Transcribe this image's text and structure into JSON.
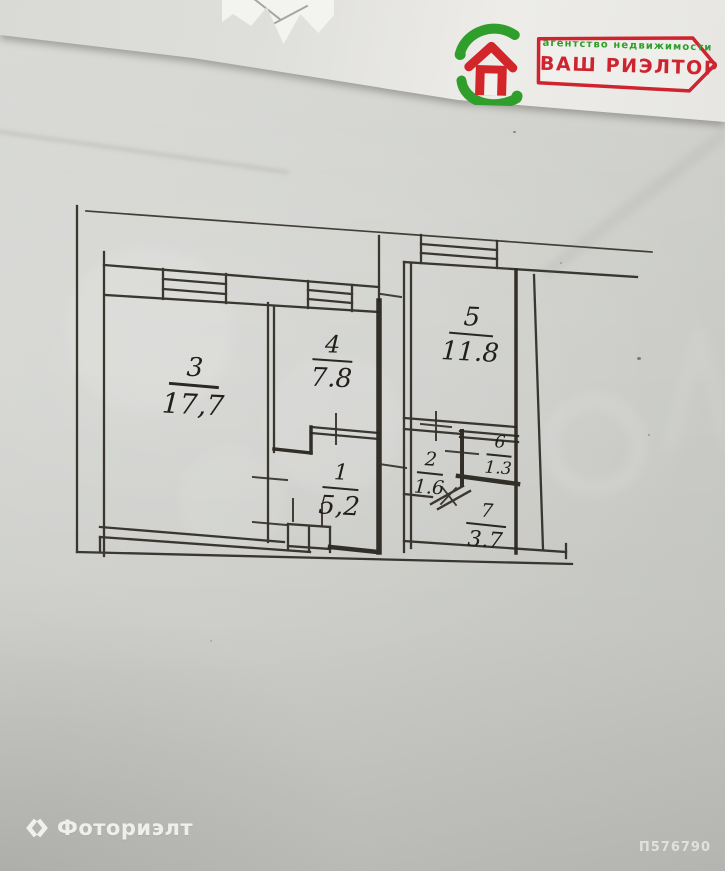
{
  "brand_card": {
    "tagline": "агентство недвижимости",
    "brand": "ВАШ РИЭЛТОР",
    "colors": {
      "red": "#cf2430",
      "green": "#2f9e2a"
    }
  },
  "floor_plan": {
    "ink_color": "#322e28",
    "rooms": [
      {
        "number": "3",
        "area": "17,7"
      },
      {
        "number": "4",
        "area": "7.8"
      },
      {
        "number": "5",
        "area": "11.8"
      },
      {
        "number": "1",
        "area": "5,2"
      },
      {
        "number": "2",
        "area": "1.6"
      },
      {
        "number": "6",
        "area": "1.3"
      },
      {
        "number": "7",
        "area": "3.7"
      }
    ]
  },
  "watermarks": {
    "service_name": "Фоториэлт",
    "photo_code": "П576790"
  }
}
